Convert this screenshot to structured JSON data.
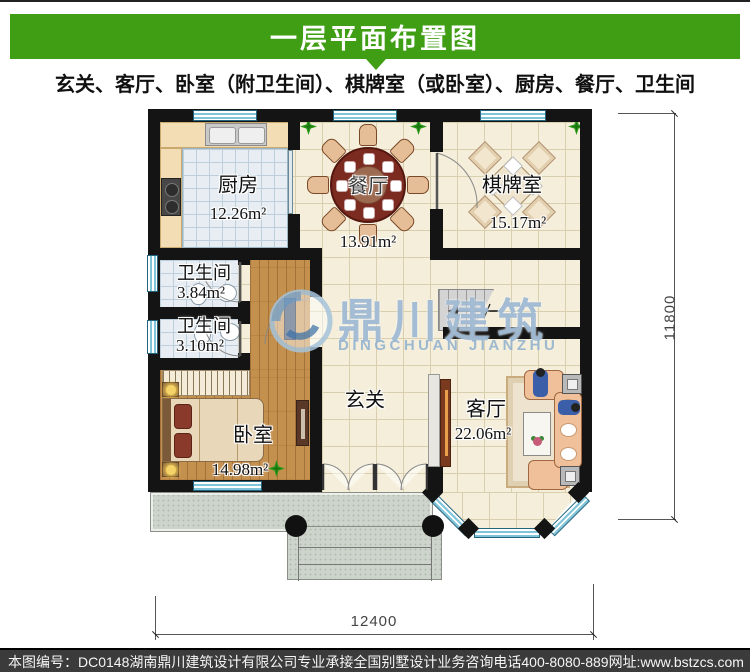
{
  "header": {
    "title": "一层平面布置图",
    "subtitle": "玄关、客厅、卧室（附卫生间）、棋牌室（或卧室）、厨房、餐厅、卫生间"
  },
  "rooms": {
    "kitchen": {
      "name": "厨房",
      "area": "12.26m²"
    },
    "dining": {
      "name": "餐厅",
      "area": "13.91m²"
    },
    "chess": {
      "name": "棋牌室",
      "area": "15.17m²"
    },
    "bath1": {
      "name": "卫生间",
      "area": "3.84m²"
    },
    "bath2": {
      "name": "卫生间",
      "area": "3.10m²"
    },
    "bedroom": {
      "name": "卧室",
      "area": "14.98m²"
    },
    "hall": {
      "name": "玄关"
    },
    "living": {
      "name": "客厅",
      "area": "22.06m²"
    }
  },
  "dimensions": {
    "bottom_width": "12400",
    "right_height": "11800"
  },
  "watermark": {
    "name_cn": "鼎川建筑",
    "name_en": "DINGCHUAN JIANZHU"
  },
  "footer": {
    "plan_no": "本图编号：DC0148",
    "company": "湖南鼎川建筑设计有限公司专业承接全国别墅设计业务",
    "phone": "咨询电话400-8080-889",
    "website": "网址:www.bstzcs.com"
  },
  "colors": {
    "accent_green": "#3f9e14",
    "wall": "#141414",
    "watermark_blue": "#94b2ce"
  }
}
